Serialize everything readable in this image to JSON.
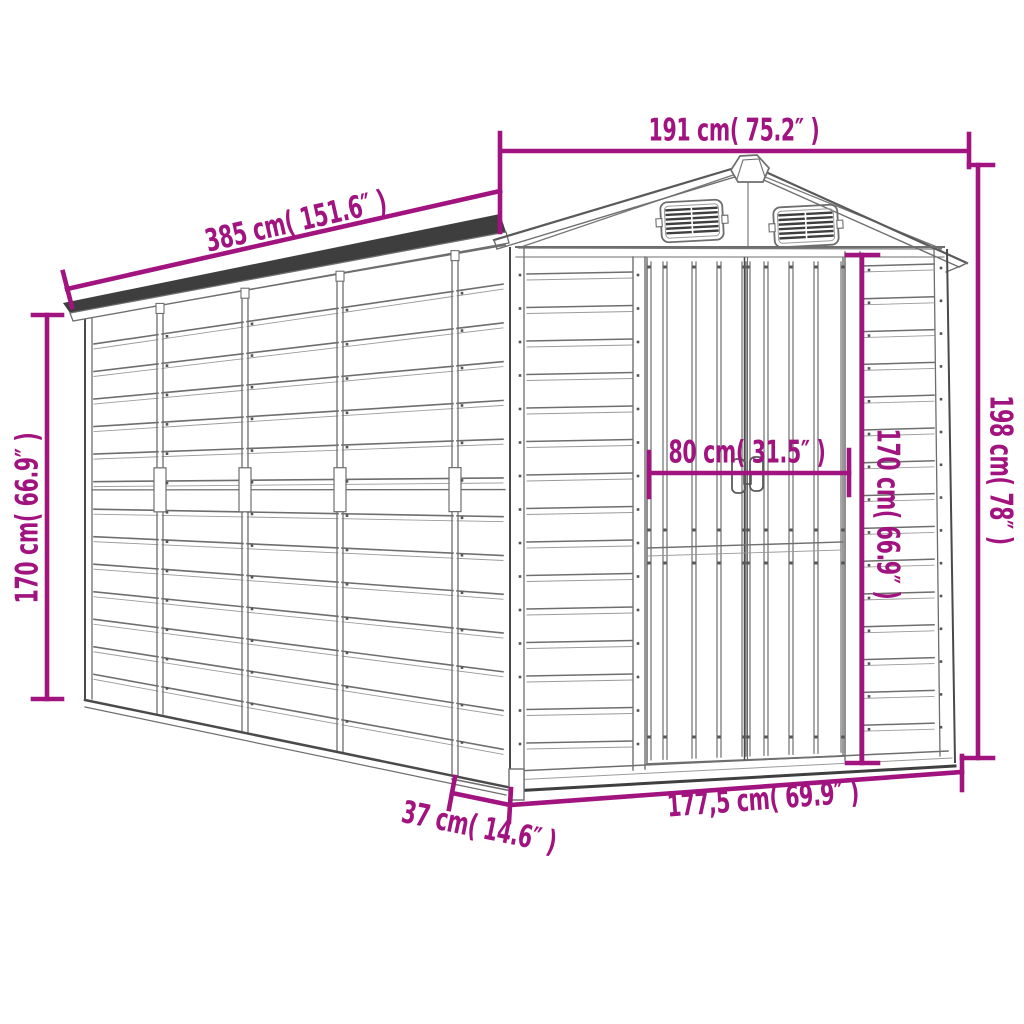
{
  "figure": {
    "type": "product dimension diagram",
    "subject": "metal garden shed with apex roof and double doors"
  },
  "dimensions": {
    "roof_width": "191 cm( 75.2″ )",
    "roof_length": "385 cm( 151.6″ )",
    "wall_height": "170 cm( 66.9″ )",
    "total_height": "198 cm( 78″ )",
    "door_width": "80 cm( 31.5″ )",
    "door_height": "170 cm( 66.9″ )",
    "front_base_width": "177,5 cm( 69.9″ )",
    "base_front_offset": "37 cm( 14.6″ )"
  },
  "colors": {
    "dimension_accent": "#A1137F",
    "roof_band": "#3E3E3E",
    "outline": "#6E6E6E",
    "background": "#FFFFFF"
  }
}
